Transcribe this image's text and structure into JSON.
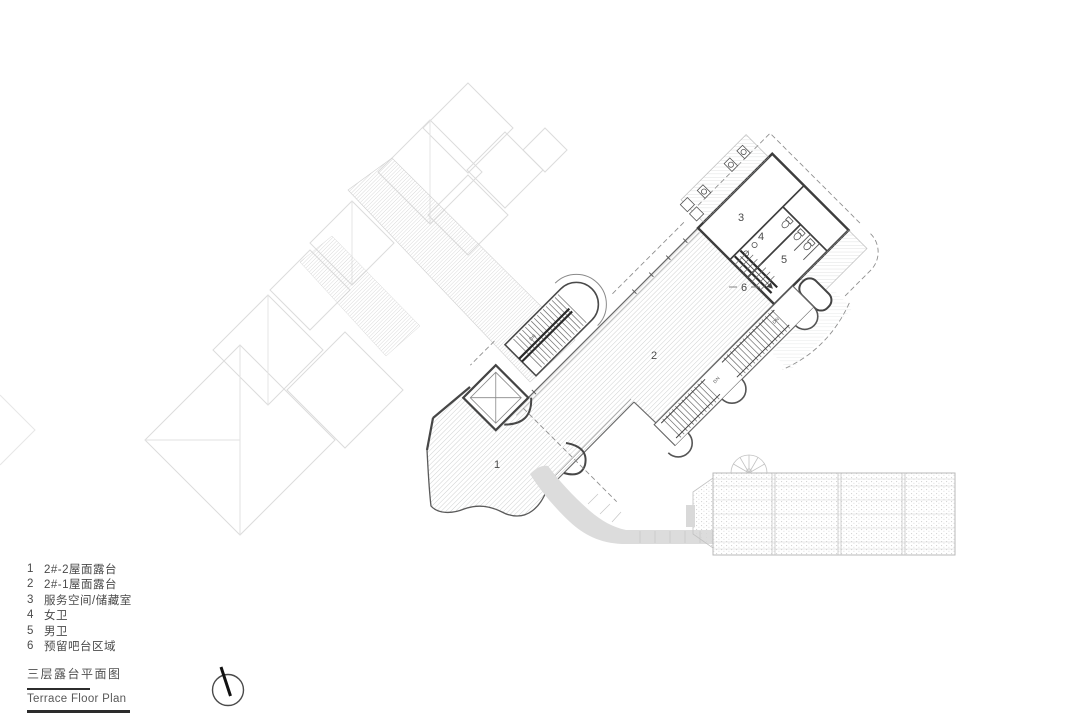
{
  "legend": {
    "items": [
      {
        "num": "1",
        "label": "2#-2屋面露台"
      },
      {
        "num": "2",
        "label": "2#-1屋面露台"
      },
      {
        "num": "3",
        "label": "服务空间/储藏室"
      },
      {
        "num": "4",
        "label": "女卫"
      },
      {
        "num": "5",
        "label": "男卫"
      },
      {
        "num": "6",
        "label": "预留吧台区域"
      }
    ]
  },
  "title_block": {
    "title_cn": "三层露台平面图",
    "title_en": "Terrace Floor Plan"
  },
  "plan": {
    "room_labels": {
      "r1": "1",
      "r2": "2",
      "r3": "3",
      "r4": "4",
      "r5": "5",
      "r6": "6"
    },
    "stair_down_label": "DN"
  },
  "colors": {
    "line_dark": "#3d3d3d",
    "line_medium": "#6a6a6a",
    "hatch_gray": "#c7c9ca",
    "walkway_gray": "#dcdcdc",
    "background_roof_gray": "#dedede",
    "ink": "#1a1a1a"
  }
}
